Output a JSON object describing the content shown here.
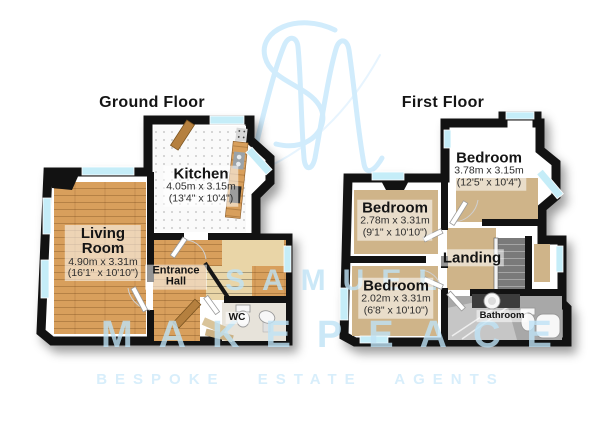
{
  "colors": {
    "wall": "#121212",
    "wood": "#d89f5c",
    "carpet": "#cfb489",
    "glass": "#c5edf8",
    "stairs": "#e9d5a7",
    "wm": "#bfe3f6",
    "wm-strong": "#cdeafc",
    "tagline": "#d6eefb",
    "label-bg": "rgba(255,255,255,0.55)"
  },
  "titles": {
    "ground": "Ground Floor",
    "first": "First Floor"
  },
  "ground_floor": {
    "rooms": [
      {
        "id": "kitchen",
        "name": "Kitchen",
        "dim_metric": "4.05m x 3.15m",
        "dim_imperial": "(13'4\" x 10'4\")"
      },
      {
        "id": "living-room",
        "name": "Living Room",
        "dim_metric": "4.90m x 3.31m",
        "dim_imperial": "(16'1\" x 10'10\")"
      },
      {
        "id": "entrance-hall",
        "name": "Entrance Hall"
      },
      {
        "id": "wc",
        "name": "WC"
      }
    ]
  },
  "first_floor": {
    "rooms": [
      {
        "id": "bedroom-1",
        "name": "Bedroom",
        "dim_metric": "3.78m x 3.15m",
        "dim_imperial": "(12'5\" x 10'4\")"
      },
      {
        "id": "bedroom-2",
        "name": "Bedroom",
        "dim_metric": "2.78m x 3.31m",
        "dim_imperial": "(9'1\" x 10'10\")"
      },
      {
        "id": "bedroom-3",
        "name": "Bedroom",
        "dim_metric": "2.02m x 3.31m",
        "dim_imperial": "(6'8\" x 10'10\")"
      },
      {
        "id": "landing",
        "name": "Landing"
      },
      {
        "id": "bathroom",
        "name": "Bathroom"
      }
    ]
  },
  "watermark": {
    "monogram": "SM",
    "brand_top": "SAMUEL",
    "brand_bottom": "MAKEPEACE",
    "tagline": "BESPOKE ESTATE AGENTS"
  }
}
